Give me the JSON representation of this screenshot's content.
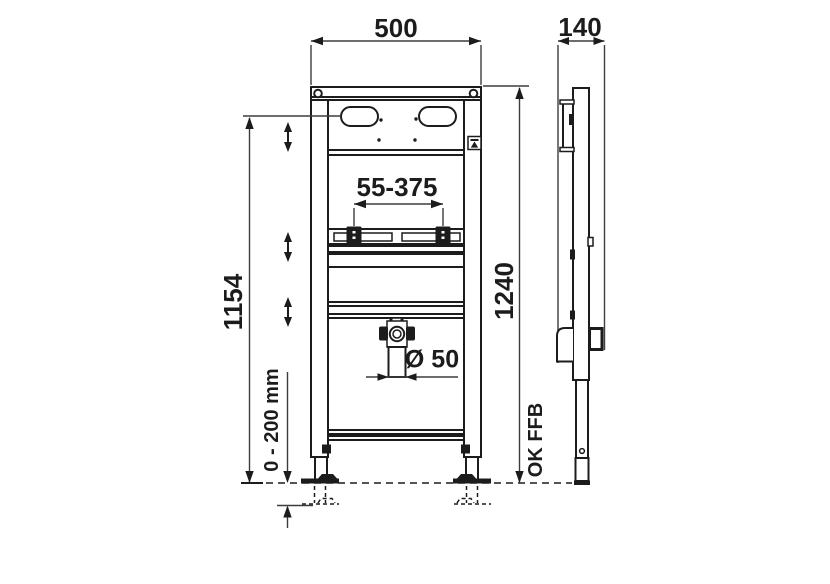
{
  "labels": {
    "frame_width": "500",
    "frame_depth": "140",
    "fixture_spacing_range": "55-375",
    "slot_height": "1154",
    "frame_height": "1240",
    "drain_diameter": "Ø 50",
    "foot_adjustment_range": "0 - 200 mm",
    "finished_floor_level": "OK FFB"
  },
  "colors": {
    "background": "#ffffff",
    "line": "#1c1c1c",
    "dimension": "#3d3d3d"
  }
}
